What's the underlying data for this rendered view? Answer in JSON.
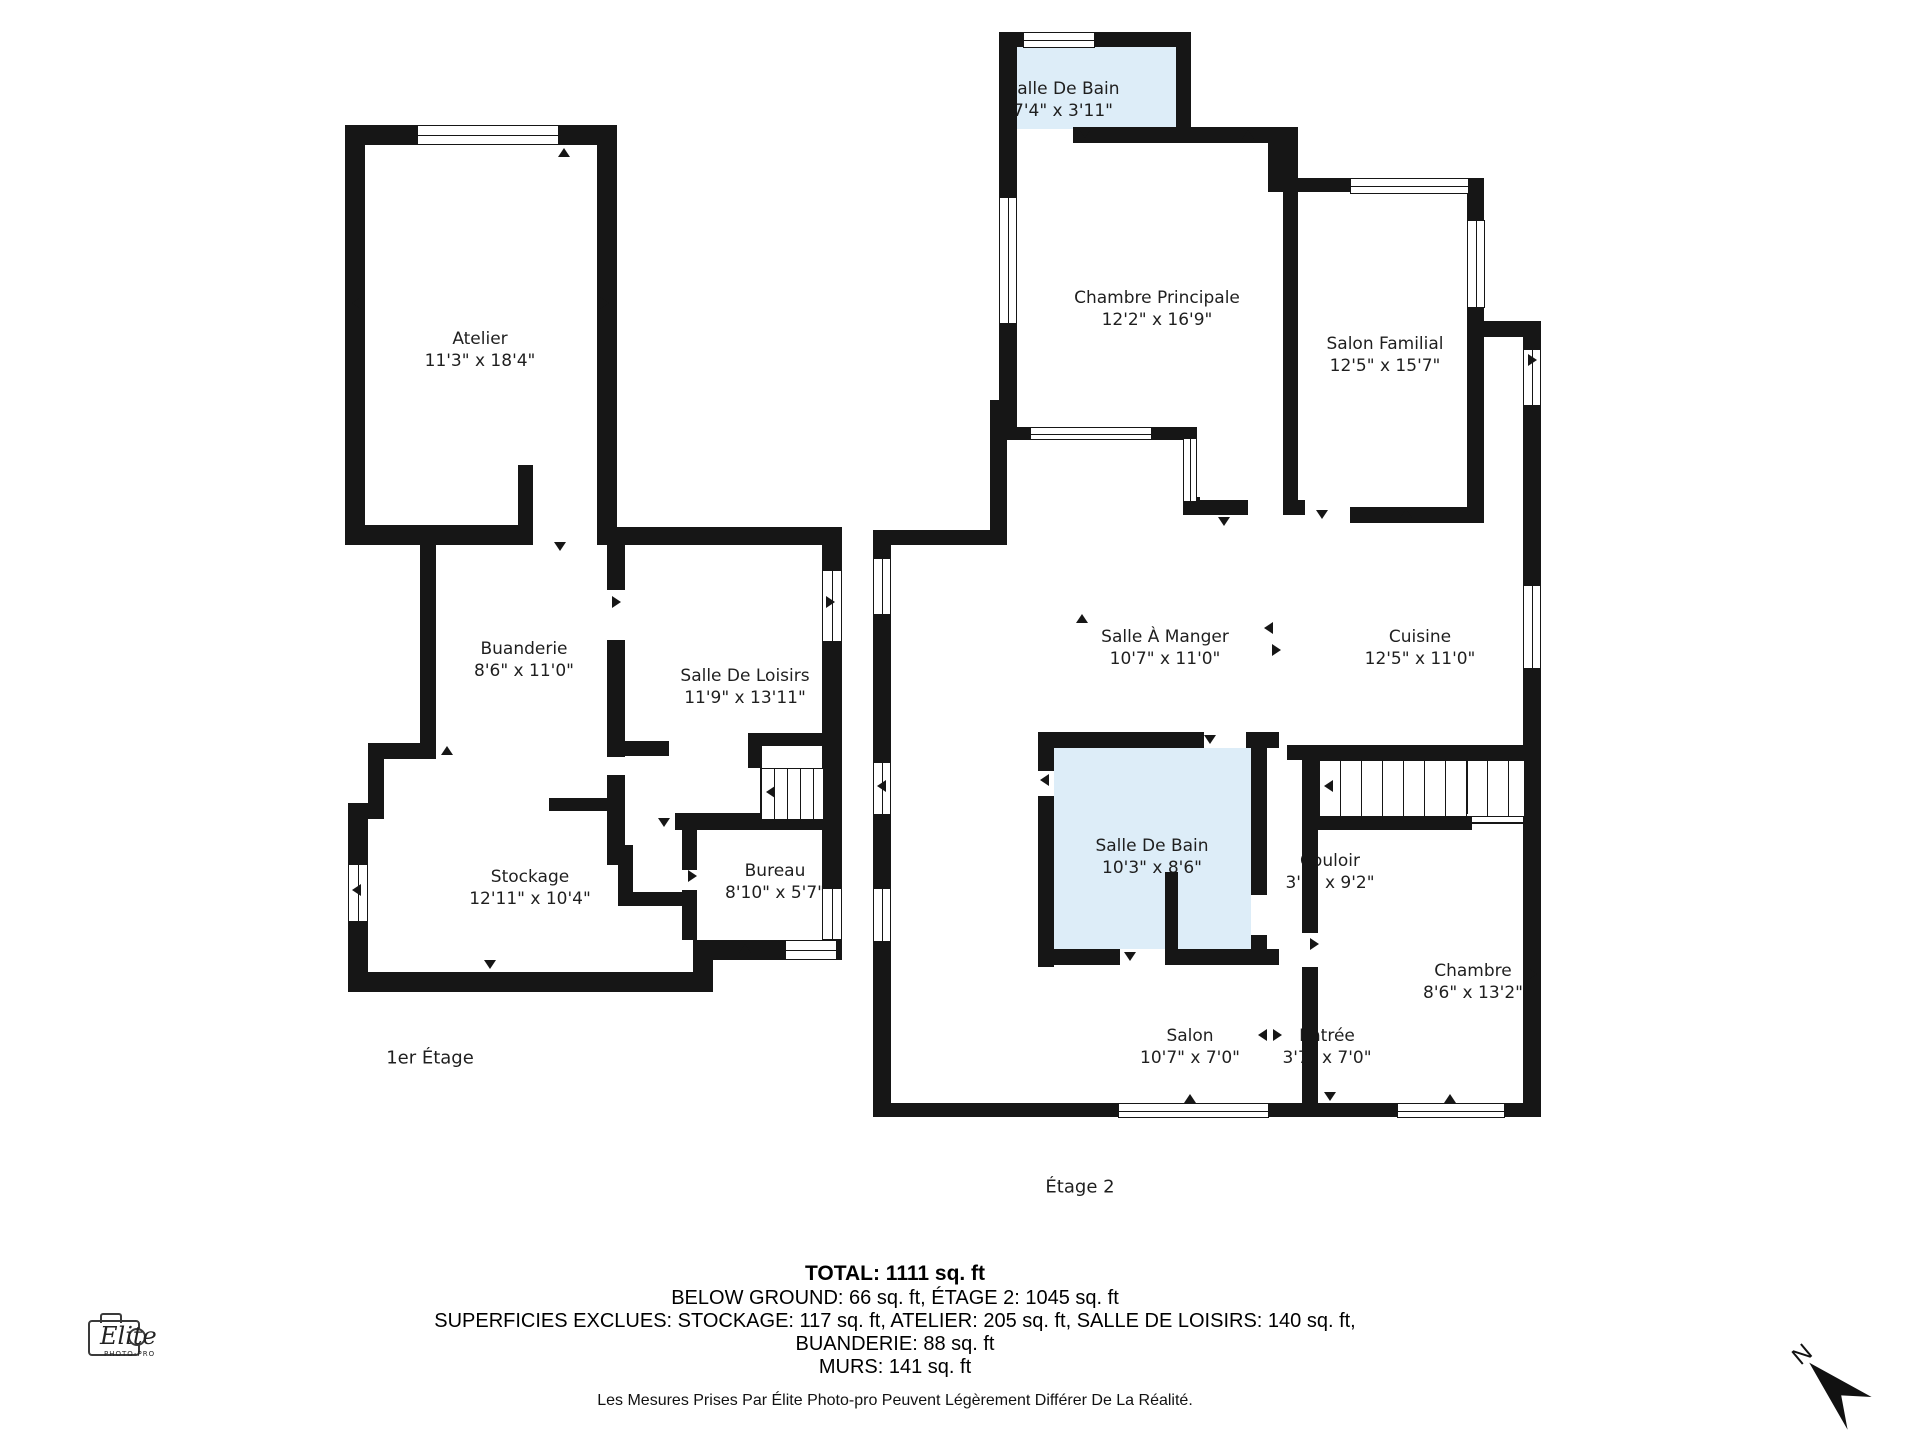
{
  "colors": {
    "wall": "#161616",
    "bathroom_fill": "#ddedf8",
    "background": "#ffffff",
    "label_text": "#1f1f1f"
  },
  "floor1": {
    "label": "1er Étage",
    "rooms": [
      {
        "name": "Atelier",
        "dims": "11'3\" x 18'4\""
      },
      {
        "name": "Buanderie",
        "dims": "8'6\" x 11'0\""
      },
      {
        "name": "Salle De Loisirs",
        "dims": "11'9\" x 13'11\""
      },
      {
        "name": "Stockage",
        "dims": "12'11\" x 10'4\""
      },
      {
        "name": "Bureau",
        "dims": "8'10\" x 5'7\""
      }
    ]
  },
  "floor2": {
    "label": "Étage 2",
    "rooms": [
      {
        "name": "Salle De Bain",
        "dims": "7'4\" x 3'11\""
      },
      {
        "name": "Chambre Principale",
        "dims": "12'2\" x 16'9\""
      },
      {
        "name": "Salon Familial",
        "dims": "12'5\" x 15'7\""
      },
      {
        "name": "Salle À Manger",
        "dims": "10'7\" x 11'0\""
      },
      {
        "name": "Cuisine",
        "dims": "12'5\" x 11'0\""
      },
      {
        "name": "Salle De Bain",
        "dims": "10'3\" x 8'6\""
      },
      {
        "name": "Couloir",
        "dims": "3'7\" x 9'2\""
      },
      {
        "name": "Chambre",
        "dims": "8'6\" x 13'2\""
      },
      {
        "name": "Salon",
        "dims": "10'7\" x 7'0\""
      },
      {
        "name": "Entrée",
        "dims": "3'7\" x 7'0\""
      }
    ]
  },
  "summary": {
    "total": "TOTAL: 1111 sq. ft",
    "line1": "BELOW GROUND: 66 sq. ft, ÉTAGE 2: 1045 sq. ft",
    "line2": "SUPERFICIES EXCLUES: STOCKAGE: 117 sq. ft, ATELIER: 205 sq. ft, SALLE DE LOISIRS: 140 sq. ft,",
    "line3": "BUANDERIE: 88 sq. ft",
    "line4": "MURS: 141 sq. ft"
  },
  "footnote": "Les Mesures Prises Par Élite Photo-pro Peuvent Légèrement Différer De La Réalité.",
  "logo": {
    "brand": "Elite",
    "subtitle": "PHOTO-PRO"
  },
  "compass": {
    "label": "N"
  }
}
